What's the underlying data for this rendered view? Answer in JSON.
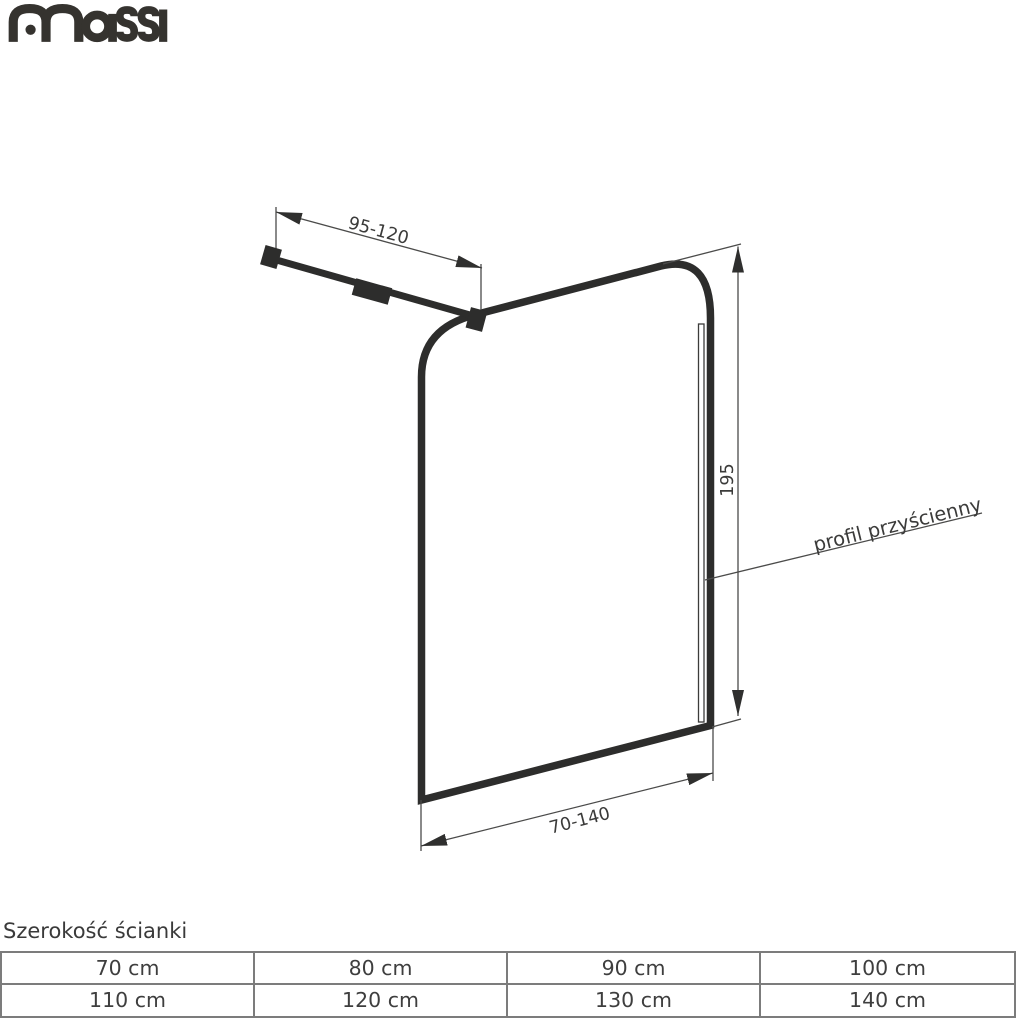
{
  "brand": {
    "name": "massi"
  },
  "diagram": {
    "arm_length_label": "95-120",
    "height_label": "195",
    "width_label": "70-140",
    "wall_profile_label": "profil przyścienny",
    "colors": {
      "ink": "#2d2d2c",
      "thin_line": "#4b4b4a",
      "label_text": "#3b3b3a",
      "logo": "#35332f",
      "table_border": "#7c7c7c"
    }
  },
  "table": {
    "title": "Szerokość ścianki",
    "rows": [
      [
        "70 cm",
        "80 cm",
        "90 cm",
        "100 cm"
      ],
      [
        "110 cm",
        "120 cm",
        "130 cm",
        "140 cm"
      ]
    ]
  }
}
